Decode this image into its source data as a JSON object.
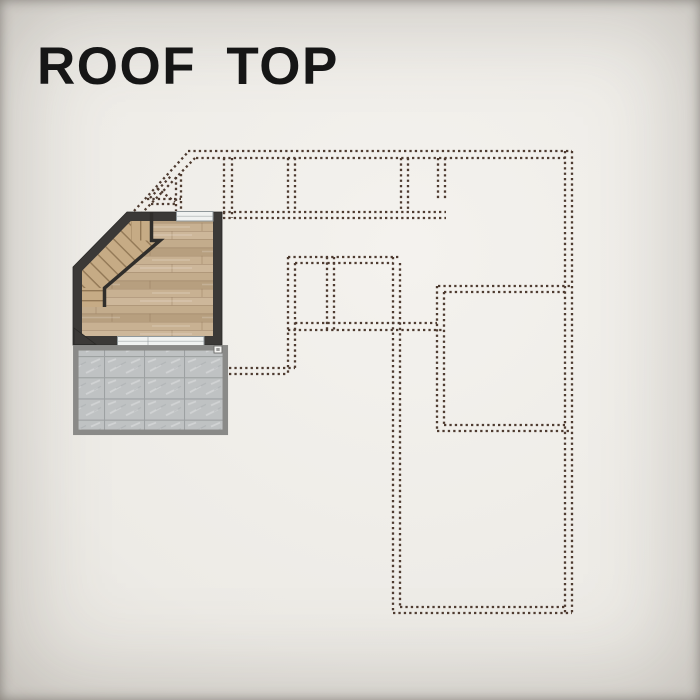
{
  "title": {
    "text": "ROOF TOP"
  },
  "plan": {
    "regions": [
      "stair-room",
      "roof-terrace",
      "lower-floor-dashed-outline"
    ]
  },
  "colors": {
    "title_text": "#161616",
    "background_center": "#f4f2ee",
    "background_edge": "#c9c6c0",
    "dashed_outline": "#4e3b30",
    "wall": "#3b3937",
    "railing": "#302e2b",
    "wood_base": "#c3ac8c",
    "wood_light": "#cdb79a",
    "wood_dark": "#b79f7f",
    "wood_mid": "#c8b192",
    "wood_seam": "#8a6f52",
    "stair_base": "#c6ab85",
    "stair_tread": "#5e4528",
    "glass": "#f0f2f1",
    "glass_frame": "#90989b",
    "terrace_border": "#8a8a88",
    "tile_base": "#bfc2c3",
    "tile_grid": "#9da1a2"
  }
}
